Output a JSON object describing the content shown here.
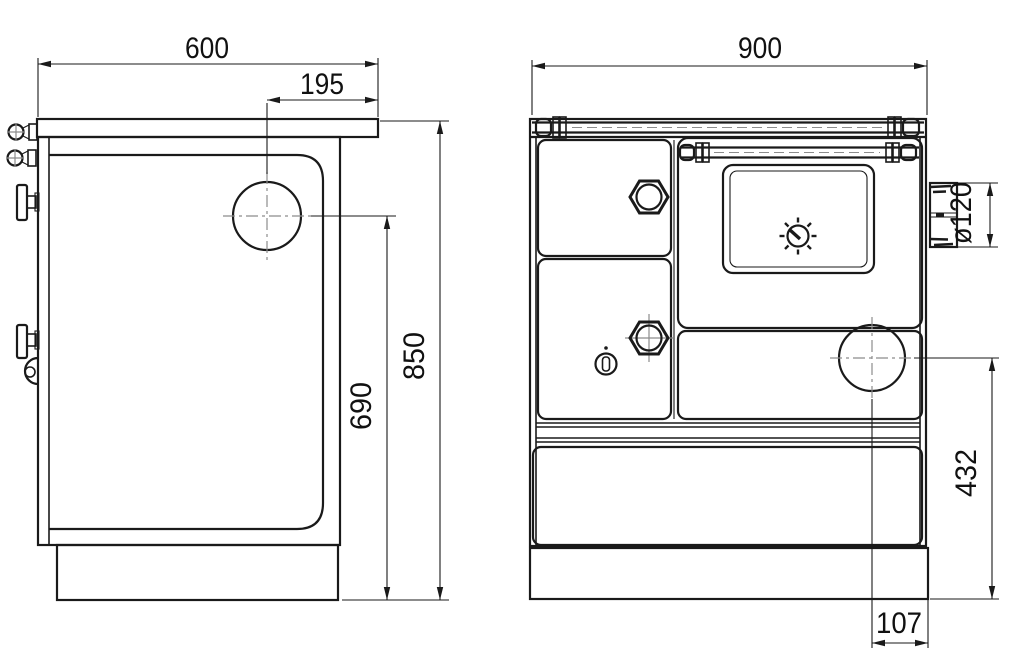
{
  "colors": {
    "background": "#ffffff",
    "line": "#1a1a1a",
    "centerline": "#8c8c8c"
  },
  "drawing_type": "stove-dimension-drawing",
  "views": {
    "side": {
      "dims": {
        "width": "600",
        "flue_offset": "195",
        "overall_height": "850",
        "flue_center_height": "690"
      }
    },
    "front": {
      "dims": {
        "width": "900",
        "flue_diameter": "ø120",
        "side_outlet_center_height": "432",
        "side_outlet_offset": "107"
      }
    }
  }
}
